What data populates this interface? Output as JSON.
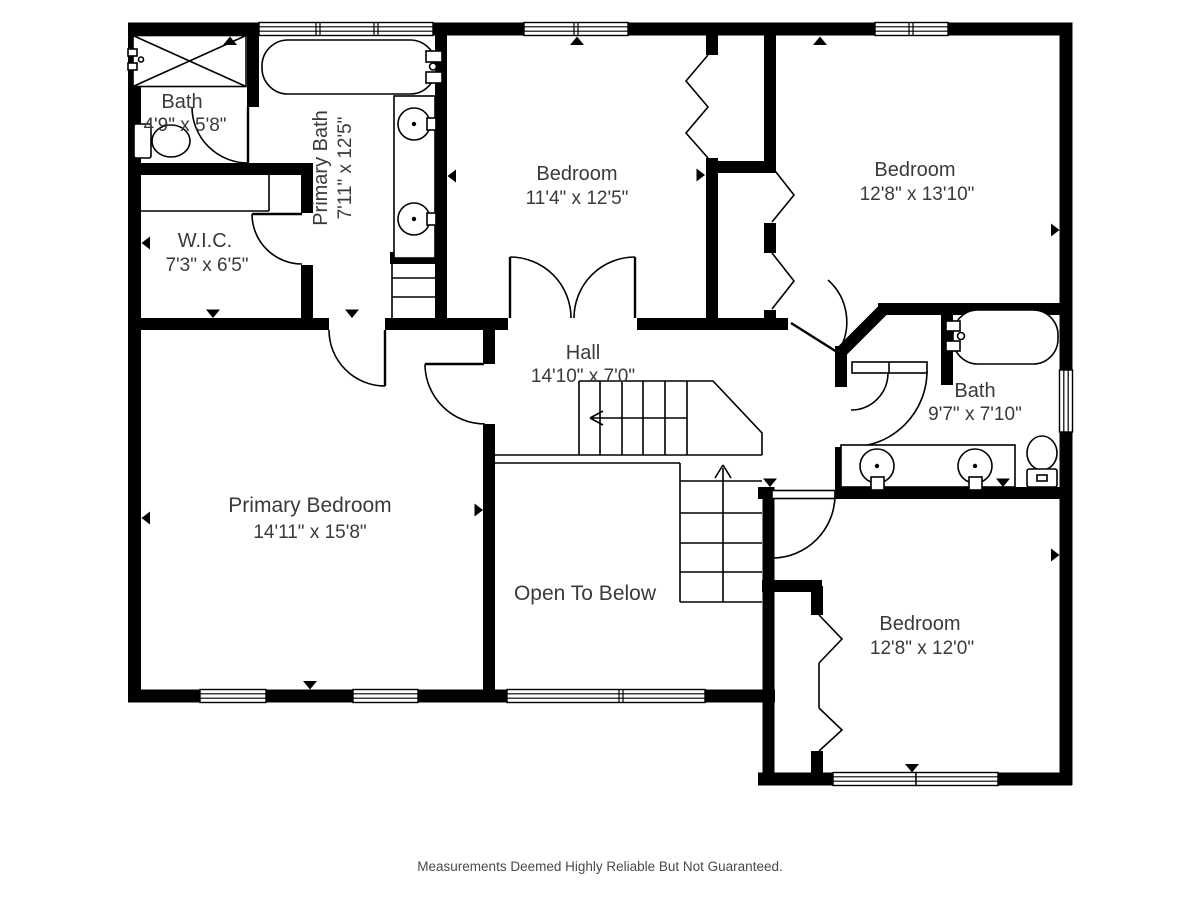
{
  "rooms": {
    "bath_small": {
      "name": "Bath",
      "dims": "4'9\" x 5'8\""
    },
    "primary_bath": {
      "name": "Primary Bath",
      "dims": "7'11\" x 12'5\""
    },
    "wic": {
      "name": "W.I.C.",
      "dims": "7'3\" x 6'5\""
    },
    "bedroom_front": {
      "name": "Bedroom",
      "dims": "11'4\" x 12'5\""
    },
    "bedroom_right": {
      "name": "Bedroom",
      "dims": "12'8\" x 13'10\""
    },
    "hall": {
      "name": "Hall",
      "dims": "14'10\" x 7'0\""
    },
    "bath_right": {
      "name": "Bath",
      "dims": "9'7\" x 7'10\""
    },
    "primary_bedroom": {
      "name": "Primary Bedroom",
      "dims": "14'11\" x 15'8\""
    },
    "open_below": {
      "name": "Open To Below"
    },
    "bedroom_bottom": {
      "name": "Bedroom",
      "dims": "12'8\" x 12'0\""
    }
  },
  "footer": {
    "disclaimer": "Measurements Deemed Highly Reliable But Not Guaranteed."
  }
}
